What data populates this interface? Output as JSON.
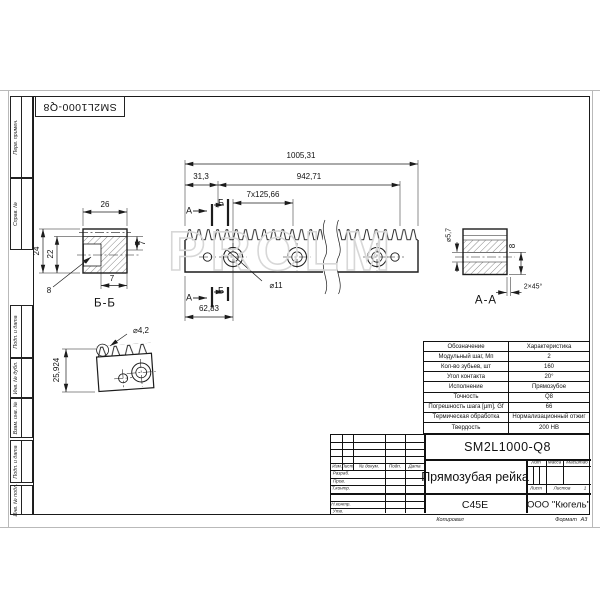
{
  "sheet": {
    "watermark": "PROLM",
    "copied": "Копировал",
    "format_label": "Формат",
    "format_value": "А3"
  },
  "margin": {
    "fields": [
      {
        "label": "Перв. примен."
      },
      {
        "label": "Справ. №"
      },
      {
        "label": "Подп. и дата"
      },
      {
        "label": "Инв. № дубл."
      },
      {
        "label": "Взам. инв. №"
      },
      {
        "label": "Подп. и дата"
      },
      {
        "label": "Инв. № подл."
      }
    ]
  },
  "top_box": {
    "designation": "SM2L1000-Q8"
  },
  "front_view": {
    "dim_total": "1005,31",
    "dim_right_span": "942,71",
    "dim_left_offset": "31,3",
    "dim_hole_pitch": "7x125,66",
    "dim_first_hole": "62,83",
    "hole_dia": "⌀11",
    "cut_label_a": "А",
    "cut_label_b": "Б"
  },
  "section_b": {
    "label": "Б-Б",
    "width": "26",
    "height": "24",
    "hole_height": "22",
    "depth_right": "7",
    "depth_bottom": "7",
    "leader": "8"
  },
  "section_a": {
    "label": "А-А",
    "hole_dia": "⌀5,7",
    "height": "8",
    "chamfer": "2×45°"
  },
  "detail_view": {
    "tip_dia": "⌀4,2",
    "height": "25,924"
  },
  "spec_table": {
    "rows": [
      {
        "label": "Обозначение",
        "value": "Характеристика"
      },
      {
        "label": "Модульный шаг, Мп",
        "value": "2"
      },
      {
        "label": "Кол-во зубьев, шт",
        "value": "160"
      },
      {
        "label": "Угол контакта",
        "value": "20°"
      },
      {
        "label": "Исполнение",
        "value": "Прямозубое"
      },
      {
        "label": "Точность",
        "value": "Q8"
      },
      {
        "label": "Погрешность шага [µm], Gf",
        "value": "66"
      },
      {
        "label": "Термическая обработка",
        "value": "Нормализационный отжиг"
      },
      {
        "label": "Твердость",
        "value": "200 НВ"
      }
    ]
  },
  "title_block": {
    "designation": "SM2L1000-Q8",
    "name": "Прямозубая рейка",
    "material": "C45E",
    "company": "ООО \"Кюгель\"",
    "col_izm": "Изм",
    "col_list": "Лист",
    "col_doc": "№ докум.",
    "col_sign": "Подп.",
    "col_date": "Дата",
    "row_razrab": "Разраб.",
    "row_prov": "Пров.",
    "row_tkontr": "Т.контр.",
    "row_nkontr": "Н.контр.",
    "row_utv": "Утв.",
    "lit": "Лит",
    "mass": "Масса",
    "scale": "Масштаб",
    "sheet": "Лист",
    "sheets": "Листов",
    "sheets_value": "1"
  }
}
